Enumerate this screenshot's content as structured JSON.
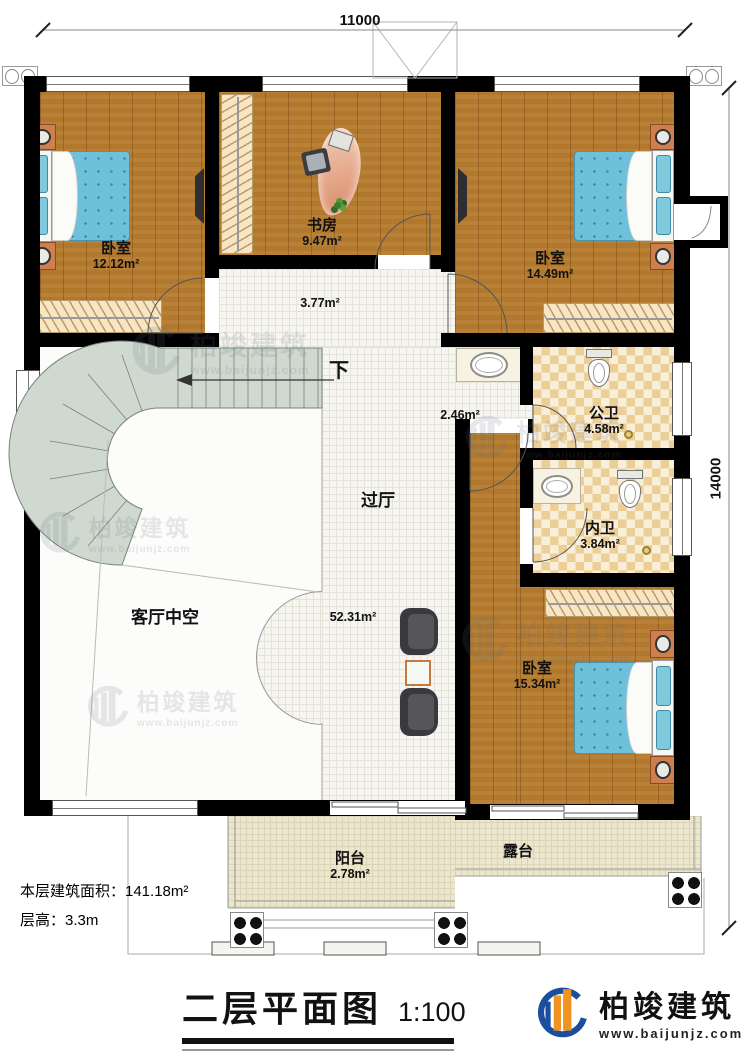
{
  "plan": {
    "title": "二层平面图",
    "scale": "1:100",
    "info_line1": "本层建筑面积：141.18m²",
    "info_line2": "层高：3.3m",
    "dim_top": "11000",
    "dim_right": "14000",
    "down_label": "下"
  },
  "rooms": {
    "bedroom_tl": {
      "name": "卧室",
      "area": "12.12m²"
    },
    "study": {
      "name": "书房",
      "area": "9.47m²"
    },
    "bedroom_tr": {
      "name": "卧室",
      "area": "14.49m²"
    },
    "hall_upper": {
      "area": "3.77m²"
    },
    "wash_corridor": {
      "area": "2.46m²"
    },
    "public_bath": {
      "name": "公卫",
      "area": "4.58m²"
    },
    "ensuite_bath": {
      "name": "内卫",
      "area": "3.84m²"
    },
    "bedroom_br": {
      "name": "卧室",
      "area": "15.34m²"
    },
    "passage": {
      "name": "过厅",
      "area": "52.31m²"
    },
    "living_void": {
      "name": "客厅中空"
    },
    "balcony": {
      "name": "阳台",
      "area": "2.78m²"
    },
    "terrace": {
      "name": "露台"
    }
  },
  "branding": {
    "company": "柏竣建筑",
    "website": "www.baijunjz.com"
  },
  "colors": {
    "wall": "#000000",
    "wood_floor": "#b2792e",
    "bath_tile": "#eccf97",
    "stair": "#cfd9cf",
    "bed": "#6fc0da",
    "balcony_tile": "#ece6cf",
    "logo_blue": "#1c4e9e",
    "logo_orange": "#f0941f"
  }
}
